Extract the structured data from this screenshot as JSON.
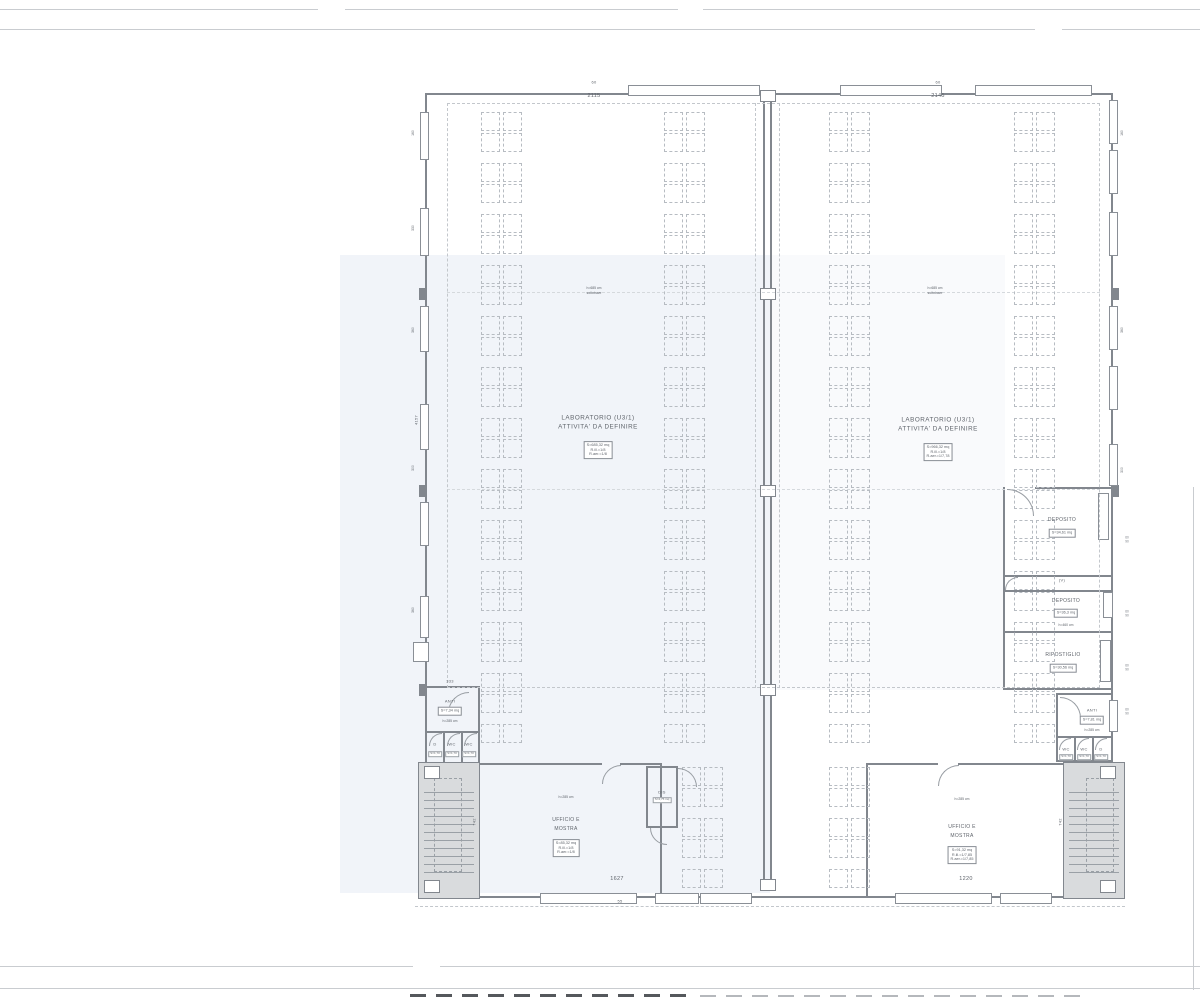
{
  "dims": {
    "win_top_left": "60",
    "top_left": "2115",
    "win_top_right": "60",
    "top_right": "2145",
    "anti_left_width": "333",
    "bottom_left": "1627",
    "bottom_offset": "55",
    "bottom_right": "1220",
    "stair_left": "742",
    "stair_right": "742",
    "left_total": "4157",
    "left_edge": [
      "160",
      "330",
      "360",
      "300",
      "360"
    ],
    "right_edge": [
      "160",
      "360",
      "300"
    ],
    "win_w": "60",
    "win_h": "90"
  },
  "rooms": {
    "lab_left": {
      "title_1": "LABORATORIO (U3/1)",
      "title_2": "ATTIVITA' DA DEFINIRE",
      "info": [
        "S=685,32 mq",
        "R.ill.=1/8",
        "R.aer.=1/8"
      ],
      "height_note_1": "h=685 cm",
      "height_note_2": "sottotrave"
    },
    "lab_right": {
      "title_1": "LABORATORIO (U3/1)",
      "title_2": "ATTIVITA' DA DEFINIRE",
      "info": [
        "S=966,32 mq",
        "R.ill.=1/8",
        "R.aer.=1/7,78"
      ],
      "height_note_1": "h=685 cm",
      "height_note_2": "sottotrave"
    },
    "deposito_1": {
      "label": "DEPOSITO",
      "area": "S=34,61 mq"
    },
    "vano": "(V)",
    "deposito_2": {
      "label": "DEPOSITO",
      "area": "S=36,3 mq",
      "height": "h=460 cm"
    },
    "ripostiglio": {
      "label": "RIPOSTIGLIO",
      "area": "S=30,56 mq"
    },
    "anti_left": {
      "label": "ANTI",
      "area": "S=7,34 mq",
      "height": "h=285 cm",
      "cells": [
        "D",
        "WC",
        "WC"
      ],
      "cell_areas": [
        "S=1,70",
        "S=1,70",
        "S=1,70"
      ]
    },
    "anti_right": {
      "label": "ANTI",
      "area": "S=7,81 mq",
      "height": "h=285 cm",
      "cells": [
        "WC",
        "WC",
        "D"
      ],
      "cell_areas": [
        "S=1,70",
        "S=1,70",
        "S=1,70"
      ]
    },
    "dis": {
      "label": "DIS",
      "area": "S=4,75 mq"
    },
    "ufficio_left": {
      "height": "h=285 cm",
      "title_1": "UFFICIO E",
      "title_2": "MOSTRA",
      "info": [
        "S=85,32 mq",
        "R.ill.=1/8",
        "R.aer.=1/8"
      ]
    },
    "ufficio_right": {
      "height": "h=285 cm",
      "title_1": "UFFICIO E",
      "title_2": "MOSTRA",
      "info": [
        "S=91,32 mq",
        "R.ill.=1/7,85",
        "R.aer.=1/7,85"
      ]
    }
  },
  "colors": {
    "wall": "#82878e",
    "dashed": "#c3c7cc",
    "equipment": "#b7bcc2",
    "stair_fill": "#d9dbdd",
    "text": "#5f646b",
    "sheet_line": "#c9ccd0",
    "tint": "#dce5f1"
  }
}
